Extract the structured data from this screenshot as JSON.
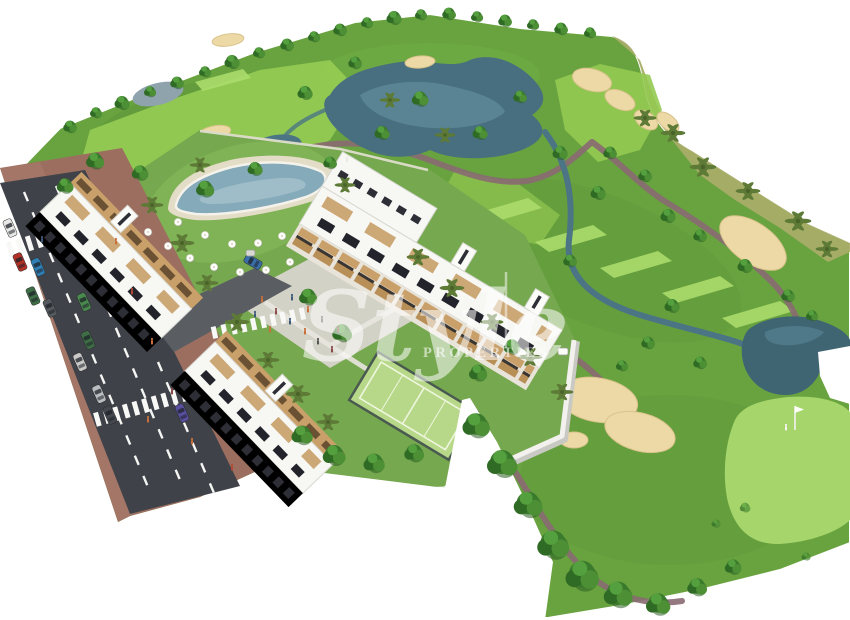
{
  "watermark": {
    "brand_script": "Style",
    "brand_caption": "PROPERTIES"
  },
  "palette": {
    "background": "#ffffff",
    "grass_base": "#68a33f",
    "fairway_light": "#93ca52",
    "mowing_stripe": "#abdc6c",
    "putting_green": "#a6d56b",
    "rough_dry_grass": "#a8ad68",
    "tree_canopy": "#3a7a2c",
    "palm_frond": "#5d7a36",
    "water": "#4b7585",
    "sand_bunker": "#ecd9a6",
    "cart_path": "#8a6a72",
    "asphalt_road": "#3f4349",
    "sidewalk_paving": "#9c6e60",
    "building_white": "#f7f7f4",
    "balcony_wood": "#c9a06a",
    "window_glass": "#2e2e36",
    "pool_water": "#85aab9",
    "padel_court": "#b7d889",
    "plaza_paving": "#d8d4cd",
    "watermark_white": "#ffffff"
  }
}
